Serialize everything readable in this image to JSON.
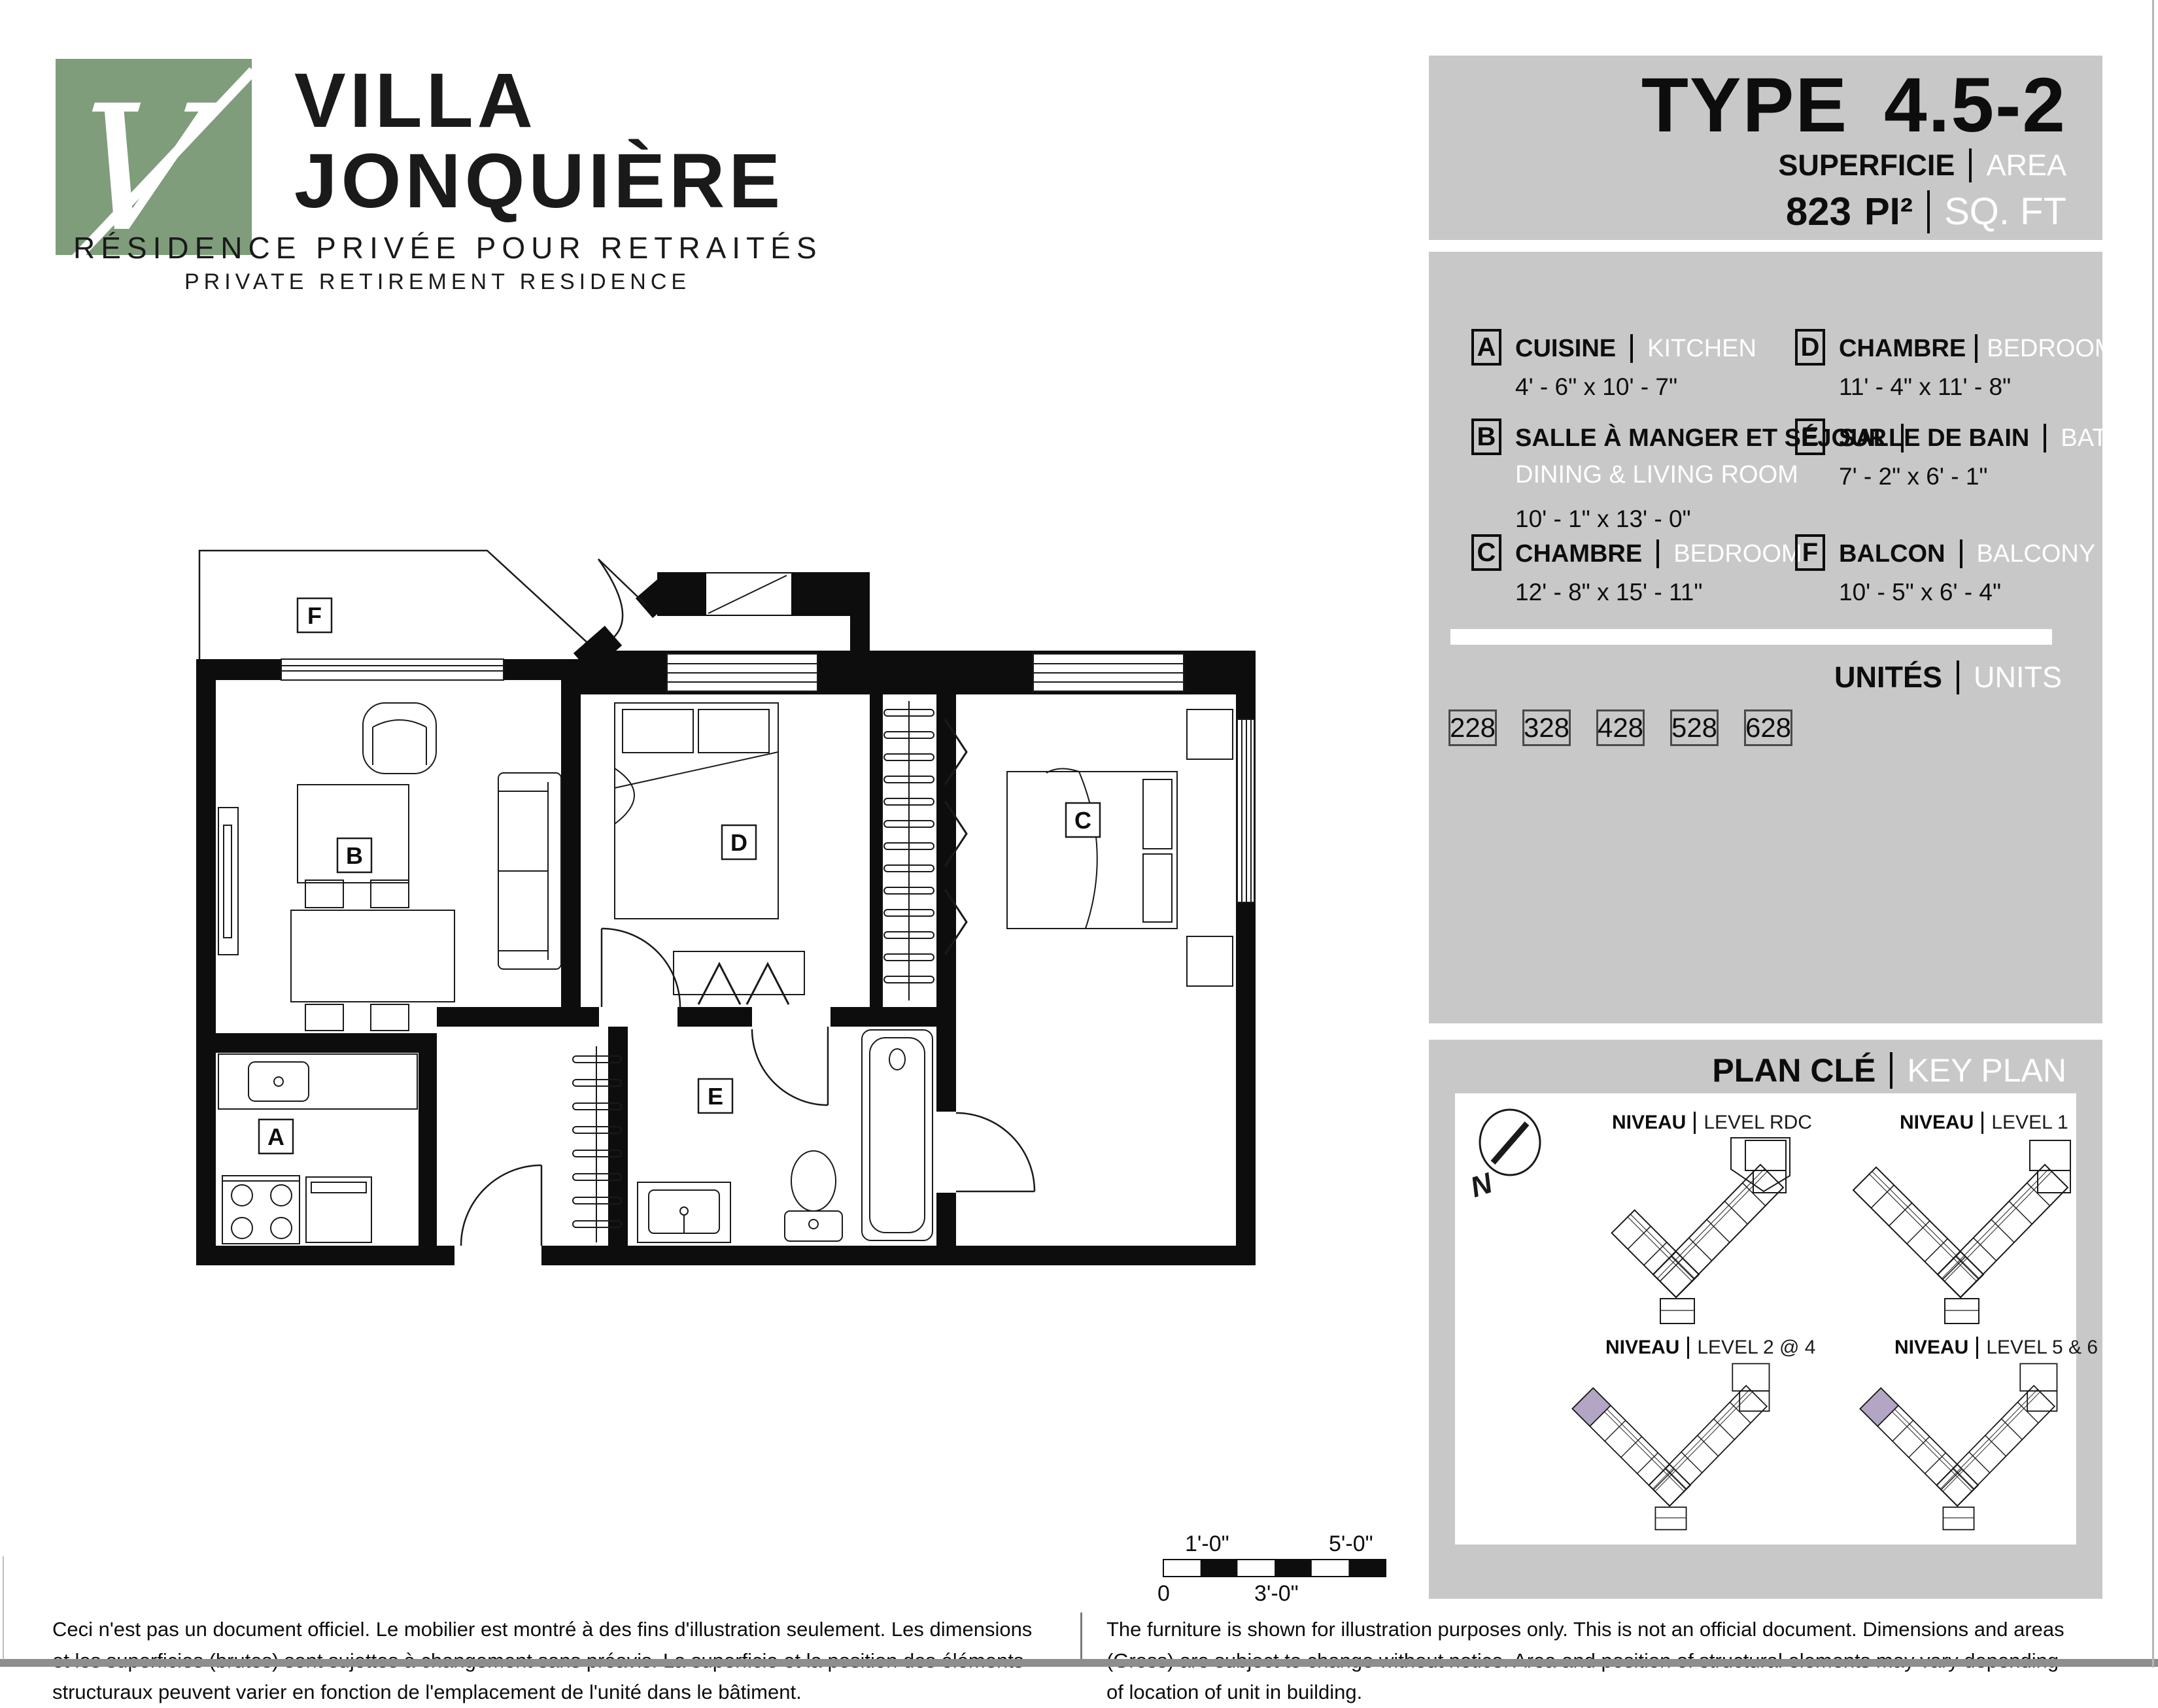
{
  "logo": {
    "name_line1": "VILLA",
    "name_line2": "JONQUIÈRE",
    "tagline_fr": "RÉSIDENCE PRIVÉE POUR RETRAITÉS",
    "tagline_en": "PRIVATE RETIREMENT RESIDENCE",
    "mark_letter": "V",
    "green": "#7f9d7b"
  },
  "header": {
    "type_label": "TYPE",
    "type_value": "4.5-2",
    "area_label_fr": "SUPERFICIE",
    "area_label_en": "AREA",
    "area_value": "823",
    "area_unit_fr": "PI²",
    "area_unit_en": "SQ. FT"
  },
  "legend": {
    "rooms": [
      {
        "letter": "A",
        "name_fr": "CUISINE",
        "name_en": "KITCHEN",
        "dims": "4' - 6\" x 10' - 7\""
      },
      {
        "letter": "B",
        "name_fr": "SALLE À MANGER ET SÉJOUR",
        "name_en": "DINING & LIVING ROOM",
        "dims": "10' - 1\" x 13' - 0\""
      },
      {
        "letter": "C",
        "name_fr": "CHAMBRE",
        "name_en": "BEDROOM",
        "dims": "12' - 8\" x 15' - 11\""
      },
      {
        "letter": "D",
        "name_fr": "CHAMBRE",
        "name_en": "BEDROOM",
        "dims": "11' - 4\" x 11' - 8\""
      },
      {
        "letter": "E",
        "name_fr": "SALLE DE BAIN",
        "name_en": "BATHROOM",
        "dims": "7' - 2\" x 6' - 1\""
      },
      {
        "letter": "F",
        "name_fr": "BALCON",
        "name_en": "BALCONY",
        "dims": "10' - 5\" x 6' - 4\""
      }
    ],
    "units_label_fr": "UNITÉS",
    "units_label_en": "UNITS",
    "units": [
      "228",
      "328",
      "428",
      "528",
      "628"
    ]
  },
  "keyplan": {
    "title_fr": "PLAN CLÉ",
    "title_en": "KEY PLAN",
    "compass": "N",
    "levels": [
      {
        "fr": "NIVEAU",
        "en": "LEVEL RDC"
      },
      {
        "fr": "NIVEAU",
        "en": "LEVEL 1"
      },
      {
        "fr": "NIVEAU",
        "en": "LEVEL 2 @ 4"
      },
      {
        "fr": "NIVEAU",
        "en": "LEVEL 5 & 6"
      }
    ],
    "highlight_color": "#b3a6c4"
  },
  "plan": {
    "labels": {
      "A": "A",
      "B": "B",
      "C": "C",
      "D": "D",
      "E": "E",
      "F": "F"
    }
  },
  "scalebar": {
    "top_left": "1'-0\"",
    "top_right": "5'-0\"",
    "bottom_left": "0",
    "bottom_mid": "3'-0\""
  },
  "disclaimers": {
    "fr": "Ceci n'est pas un document officiel.  Le mobilier est montré à des fins d'illustration seulement.  Les dimensions et les superficies (brutes) sont sujettes à changement sans préavis. La superficie et la position des éléments structuraux peuvent varier en fonction de l'emplacement de l'unité dans le bâtiment.",
    "en": "The furniture is shown for illustration purposes only.  This is not an official document.  Dimensions and areas (Gross) are subject to change without notice.  Area and position of structural elements may vary depending of location of unit in building."
  }
}
